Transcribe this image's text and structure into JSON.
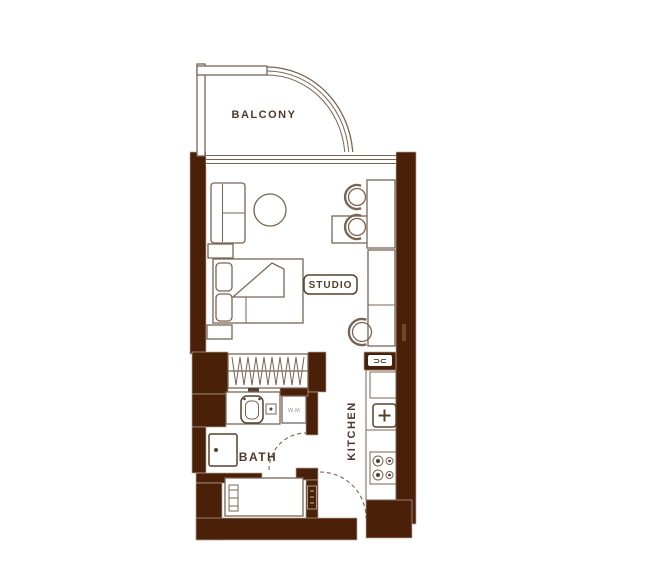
{
  "plan": {
    "type": "apartment-floor-plan",
    "labels": {
      "balcony": "BALCONY",
      "studio": "STUDIO",
      "bath": "BATH",
      "kitchen": "KITCHEN",
      "washing_machine": "W.M",
      "wall_fixture": "⊃⊂"
    },
    "colors": {
      "wall": "#4a2008",
      "wall_edge": "#b9a89a",
      "line": "#7a6553",
      "line_dark": "#56402e",
      "text": "#4f382b",
      "background": "#ffffff"
    },
    "rooms": [
      {
        "name": "balcony",
        "label": "BALCONY",
        "features": [
          "curved-outer-wall",
          "sliding-window-to-studio"
        ]
      },
      {
        "name": "studio",
        "label": "STUDIO",
        "furniture": [
          "sofa",
          "side-table",
          "round-table",
          "double-bed",
          "pillows",
          "nightstand",
          "dining-table",
          "dining-chairs",
          "desk",
          "desk-chair"
        ]
      },
      {
        "name": "wardrobe",
        "label": "",
        "furniture": [
          "hanging-rail-closet"
        ]
      },
      {
        "name": "bath",
        "label": "BATH",
        "fixtures": [
          "vanity-counter",
          "toilet",
          "flush-box",
          "washbasin",
          "washing-machine",
          "bathtub",
          "door-swing"
        ]
      },
      {
        "name": "kitchen",
        "label": "KITCHEN",
        "fixtures": [
          "counter",
          "sink-unit",
          "four-burner-stove"
        ]
      },
      {
        "name": "hallway",
        "label": "",
        "fixtures": [
          "entry-door-swing"
        ]
      }
    ]
  }
}
